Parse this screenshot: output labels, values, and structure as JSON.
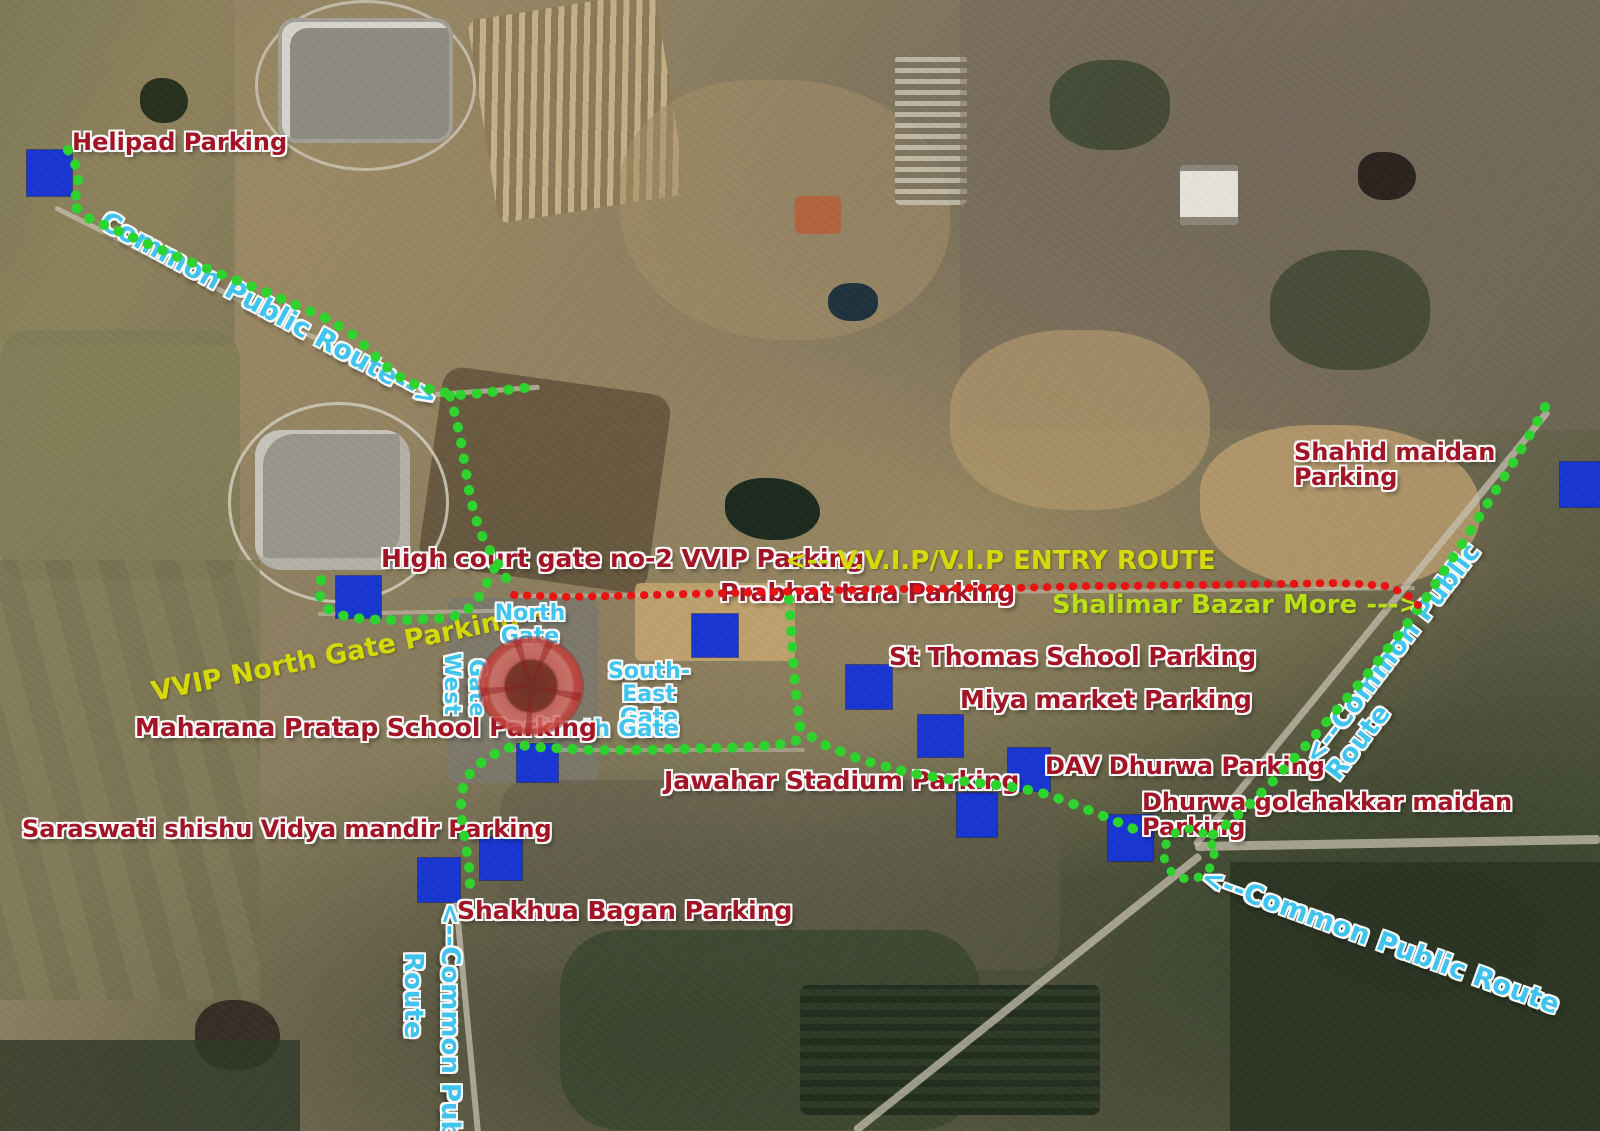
{
  "title": "Stadium area parking & routes annotated satellite map",
  "colors": {
    "common_public_route": "#2ed32e",
    "vvip_entry_route": "#e81414",
    "parking_square": "#1836d6",
    "parking_label": "#a51325",
    "route_label_cyan": "#3fc8f5",
    "vvip_label_yellow": "#dade06",
    "bazar_label_lime": "#bfe414",
    "stadium_overlay": "#c4463e"
  },
  "parking_squares": [
    {
      "id": "helipad",
      "x": 27,
      "y": 150,
      "w": 45,
      "h": 46
    },
    {
      "id": "high-court-gate2",
      "x": 336,
      "y": 576,
      "w": 45,
      "h": 42
    },
    {
      "id": "prabhat-tara",
      "x": 692,
      "y": 614,
      "w": 46,
      "h": 43
    },
    {
      "id": "st-thomas",
      "x": 846,
      "y": 665,
      "w": 46,
      "h": 44
    },
    {
      "id": "miya-market",
      "x": 918,
      "y": 715,
      "w": 45,
      "h": 42
    },
    {
      "id": "dav-dhurwa",
      "x": 1008,
      "y": 748,
      "w": 42,
      "h": 43
    },
    {
      "id": "jawahar-stadium",
      "x": 957,
      "y": 793,
      "w": 40,
      "h": 44
    },
    {
      "id": "dhurwa-golchakkar",
      "x": 1108,
      "y": 815,
      "w": 45,
      "h": 46
    },
    {
      "id": "saraswati",
      "x": 418,
      "y": 858,
      "w": 42,
      "h": 44
    },
    {
      "id": "shakhua-bagan",
      "x": 480,
      "y": 837,
      "w": 42,
      "h": 43
    },
    {
      "id": "south-gate-parking",
      "x": 517,
      "y": 744,
      "w": 41,
      "h": 38
    },
    {
      "id": "shahid-maidan",
      "x": 1560,
      "y": 462,
      "w": 40,
      "h": 45
    }
  ],
  "labels": [
    {
      "id": "helipad-parking",
      "text": "Helipad  Parking",
      "x": 72,
      "y": 130,
      "size": 24,
      "color": "red",
      "rot": 0
    },
    {
      "id": "common-public-route-topleft",
      "text": "Common Public Route-->",
      "x": 102,
      "y": 206,
      "size": 27,
      "color": "cyan",
      "rot": 28.5
    },
    {
      "id": "shahid-maidan-parking",
      "text": "Shahid maidan Parking",
      "x": 1294,
      "y": 440,
      "size": 24,
      "color": "red",
      "rot": 0
    },
    {
      "id": "high-court-parking",
      "text": "High court gate no-2  VVIP Parking",
      "x": 381,
      "y": 546,
      "size": 25,
      "color": "red",
      "rot": 0
    },
    {
      "id": "vvip-entry-route",
      "text": "<-- V.V.I.P/V.I.P ENTRY ROUTE",
      "x": 785,
      "y": 548,
      "size": 26,
      "color": "yellow",
      "rot": 0
    },
    {
      "id": "prabhat-tara-parking",
      "text": "Prabhat tara  Parking",
      "x": 720,
      "y": 580,
      "size": 25,
      "color": "red",
      "rot": 0
    },
    {
      "id": "shalimar-bazar-more",
      "text": "Shalimar Bazar More --->",
      "x": 1052,
      "y": 592,
      "size": 26,
      "color": "lime",
      "rot": 0
    },
    {
      "id": "vvip-north-gate-parking",
      "text": "VVIP North Gate Parking-->",
      "x": 152,
      "y": 679,
      "size": 27,
      "color": "yellow",
      "rot": -11.5
    },
    {
      "id": "north-gate",
      "text": "North\nGate",
      "x": 494,
      "y": 602,
      "size": 22,
      "color": "cyan",
      "rot": 0,
      "align": "center",
      "width": 72
    },
    {
      "id": "west-gate-west",
      "text": "West",
      "x": 463,
      "y": 653,
      "size": 22,
      "color": "cyan",
      "rot": 90,
      "origin": "0 0"
    },
    {
      "id": "west-gate-gate",
      "text": "Gate",
      "x": 488,
      "y": 659,
      "size": 22,
      "color": "cyan",
      "rot": 90,
      "origin": "0 0"
    },
    {
      "id": "south-east-gate",
      "text": "South-East\nGate",
      "x": 593,
      "y": 660,
      "size": 22,
      "color": "cyan",
      "rot": 0,
      "align": "center",
      "width": 112
    },
    {
      "id": "south-gate",
      "text": "South Gate",
      "x": 534,
      "y": 717,
      "size": 23,
      "color": "cyan",
      "rot": 0
    },
    {
      "id": "maharana-pratap-parking",
      "text": "Maharana Pratap School  Parking",
      "x": 135,
      "y": 715,
      "size": 25,
      "color": "red",
      "rot": 0
    },
    {
      "id": "st-thomas-parking",
      "text": "St Thomas School  Parking",
      "x": 889,
      "y": 644,
      "size": 25,
      "color": "red",
      "rot": 0
    },
    {
      "id": "miya-market-parking",
      "text": "Miya market  Parking",
      "x": 960,
      "y": 687,
      "size": 25,
      "color": "red",
      "rot": 0
    },
    {
      "id": "jawahar-stadium-parking",
      "text": "Jawahar Stadium Parking",
      "x": 664,
      "y": 768,
      "size": 25,
      "color": "red",
      "rot": 0
    },
    {
      "id": "dav-dhurwa-parking",
      "text": "DAV Dhurwa Parking",
      "x": 1045,
      "y": 754,
      "size": 24,
      "color": "red",
      "rot": 0
    },
    {
      "id": "dhurwa-golchakkar-parking",
      "text": "Dhurwa golchakkar maidan Parking",
      "x": 1142,
      "y": 790,
      "size": 24,
      "color": "red",
      "rot": 0
    },
    {
      "id": "saraswati-parking",
      "text": "Saraswati shishu Vidya  mandir  Parking",
      "x": 22,
      "y": 817,
      "size": 24,
      "color": "red",
      "rot": 0
    },
    {
      "id": "shakhua-bagan-parking",
      "text": "Shakhua Bagan  Parking",
      "x": 457,
      "y": 898,
      "size": 25,
      "color": "red",
      "rot": 0
    },
    {
      "id": "common-public-route-right",
      "text": "<--Common Public Route",
      "x": 1322,
      "y": 742,
      "size": 26,
      "color": "cyan",
      "rot": -52.5
    },
    {
      "id": "common-public-route-bottomright",
      "text": "<--Common Public Route",
      "x": 1202,
      "y": 863,
      "size": 27,
      "color": "cyan",
      "rot": 20
    },
    {
      "id": "common-public-route-bottomleft-1",
      "text": "<--Common Public",
      "x": 463,
      "y": 903,
      "size": 26,
      "color": "cyan",
      "rot": 90,
      "origin": "0 0"
    },
    {
      "id": "common-public-route-bottomleft-2",
      "text": "Route",
      "x": 426,
      "y": 952,
      "size": 26,
      "color": "cyan",
      "rot": 90,
      "origin": "0 0"
    }
  ],
  "routes": {
    "common_public": {
      "name": "Common Public Route",
      "color": "#2ed32e",
      "width": 10,
      "segments": {
        "helipad_to_junction": [
          [
            68,
            150
          ],
          [
            77,
            168
          ],
          [
            79,
            188
          ],
          [
            72,
            204
          ],
          [
            88,
            218
          ],
          [
            118,
            231
          ],
          [
            148,
            244
          ],
          [
            178,
            257
          ],
          [
            208,
            269
          ],
          [
            238,
            281
          ],
          [
            268,
            293
          ],
          [
            298,
            306
          ],
          [
            328,
            319
          ],
          [
            352,
            334
          ],
          [
            368,
            349
          ],
          [
            382,
            363
          ],
          [
            398,
            376
          ],
          [
            418,
            386
          ],
          [
            440,
            392
          ],
          [
            462,
            395
          ],
          [
            484,
            393
          ],
          [
            506,
            390
          ],
          [
            524,
            388
          ],
          [
            536,
            387
          ]
        ],
        "junction_south_branch": [
          [
            450,
            396
          ],
          [
            456,
            418
          ],
          [
            461,
            442
          ],
          [
            465,
            466
          ],
          [
            469,
            490
          ],
          [
            474,
            513
          ],
          [
            481,
            534
          ],
          [
            491,
            552
          ],
          [
            500,
            567
          ],
          [
            507,
            580
          ],
          [
            512,
            591
          ]
        ],
        "west_gate_loop": [
          [
            321,
            580
          ],
          [
            320,
            597
          ],
          [
            328,
            609
          ],
          [
            344,
            616
          ],
          [
            363,
            619
          ],
          [
            384,
            620
          ],
          [
            405,
            620
          ],
          [
            426,
            619
          ],
          [
            446,
            618
          ],
          [
            462,
            614
          ],
          [
            474,
            604
          ],
          [
            482,
            592
          ],
          [
            489,
            579
          ],
          [
            495,
            567
          ],
          [
            500,
            557
          ]
        ],
        "south_stadium_loop": [
          [
            789,
            599
          ],
          [
            790,
            614
          ],
          [
            791,
            629
          ],
          [
            792,
            644
          ],
          [
            793,
            659
          ],
          [
            794,
            674
          ],
          [
            796,
            689
          ],
          [
            797,
            704
          ],
          [
            799,
            718
          ],
          [
            801,
            731
          ],
          [
            798,
            740
          ],
          [
            782,
            744
          ],
          [
            763,
            746
          ],
          [
            744,
            747
          ],
          [
            725,
            748
          ],
          [
            706,
            748
          ],
          [
            687,
            749
          ],
          [
            668,
            749
          ],
          [
            649,
            750
          ],
          [
            630,
            750
          ],
          [
            611,
            750
          ],
          [
            592,
            750
          ],
          [
            573,
            749
          ],
          [
            554,
            748
          ],
          [
            536,
            747
          ],
          [
            519,
            745
          ],
          [
            504,
            749
          ],
          [
            489,
            757
          ],
          [
            477,
            766
          ],
          [
            468,
            776
          ],
          [
            463,
            788
          ],
          [
            461,
            801
          ],
          [
            461,
            814
          ],
          [
            463,
            827
          ],
          [
            465,
            840
          ],
          [
            467,
            853
          ],
          [
            469,
            866
          ],
          [
            470,
            879
          ],
          [
            470,
            891
          ]
        ],
        "east_to_golchakkar": [
          [
            800,
            726
          ],
          [
            812,
            737
          ],
          [
            827,
            746
          ],
          [
            844,
            753
          ],
          [
            862,
            760
          ],
          [
            880,
            765
          ],
          [
            898,
            770
          ],
          [
            916,
            774
          ],
          [
            934,
            777
          ],
          [
            952,
            780
          ],
          [
            970,
            782
          ],
          [
            988,
            784
          ],
          [
            1006,
            786
          ],
          [
            1024,
            789
          ],
          [
            1042,
            793
          ],
          [
            1060,
            799
          ],
          [
            1078,
            806
          ],
          [
            1096,
            813
          ],
          [
            1113,
            820
          ],
          [
            1129,
            827
          ],
          [
            1144,
            833
          ]
        ],
        "right_diagonal": [
          [
            1545,
            407
          ],
          [
            1536,
            424
          ],
          [
            1526,
            441
          ],
          [
            1516,
            458
          ],
          [
            1506,
            474
          ],
          [
            1496,
            490
          ],
          [
            1486,
            506
          ],
          [
            1476,
            522
          ],
          [
            1466,
            538
          ],
          [
            1456,
            553
          ],
          [
            1446,
            568
          ],
          [
            1436,
            583
          ],
          [
            1426,
            598
          ],
          [
            1415,
            613
          ],
          [
            1404,
            628
          ],
          [
            1393,
            642
          ],
          [
            1382,
            656
          ],
          [
            1371,
            670
          ],
          [
            1359,
            684
          ],
          [
            1347,
            698
          ],
          [
            1335,
            712
          ],
          [
            1323,
            726
          ],
          [
            1311,
            740
          ],
          [
            1299,
            753
          ],
          [
            1287,
            766
          ],
          [
            1275,
            779
          ],
          [
            1263,
            791
          ],
          [
            1251,
            803
          ],
          [
            1239,
            814
          ],
          [
            1227,
            824
          ],
          [
            1215,
            833
          ],
          [
            1206,
            840
          ]
        ]
      },
      "golchakkar_circle": {
        "cx": 1189,
        "cy": 854,
        "r": 25
      }
    },
    "vvip_entry": {
      "name": "V.V.I.P/V.I.P Entry Route",
      "color": "#e81414",
      "width": 8,
      "points": [
        [
          514,
          595
        ],
        [
          540,
          596
        ],
        [
          570,
          597
        ],
        [
          610,
          596
        ],
        [
          650,
          595
        ],
        [
          690,
          594
        ],
        [
          730,
          593
        ],
        [
          770,
          592
        ],
        [
          810,
          591
        ],
        [
          850,
          590
        ],
        [
          890,
          589
        ],
        [
          930,
          589
        ],
        [
          970,
          588
        ],
        [
          1010,
          588
        ],
        [
          1050,
          587
        ],
        [
          1090,
          586
        ],
        [
          1130,
          586
        ],
        [
          1170,
          585
        ],
        [
          1210,
          585
        ],
        [
          1250,
          584
        ],
        [
          1290,
          584
        ],
        [
          1330,
          583
        ],
        [
          1360,
          584
        ],
        [
          1385,
          586
        ],
        [
          1402,
          592
        ],
        [
          1413,
          599
        ],
        [
          1418,
          605
        ]
      ]
    }
  },
  "stadium": {
    "name": "JSCA stadium highlighted",
    "cx": 531,
    "cy": 686
  }
}
